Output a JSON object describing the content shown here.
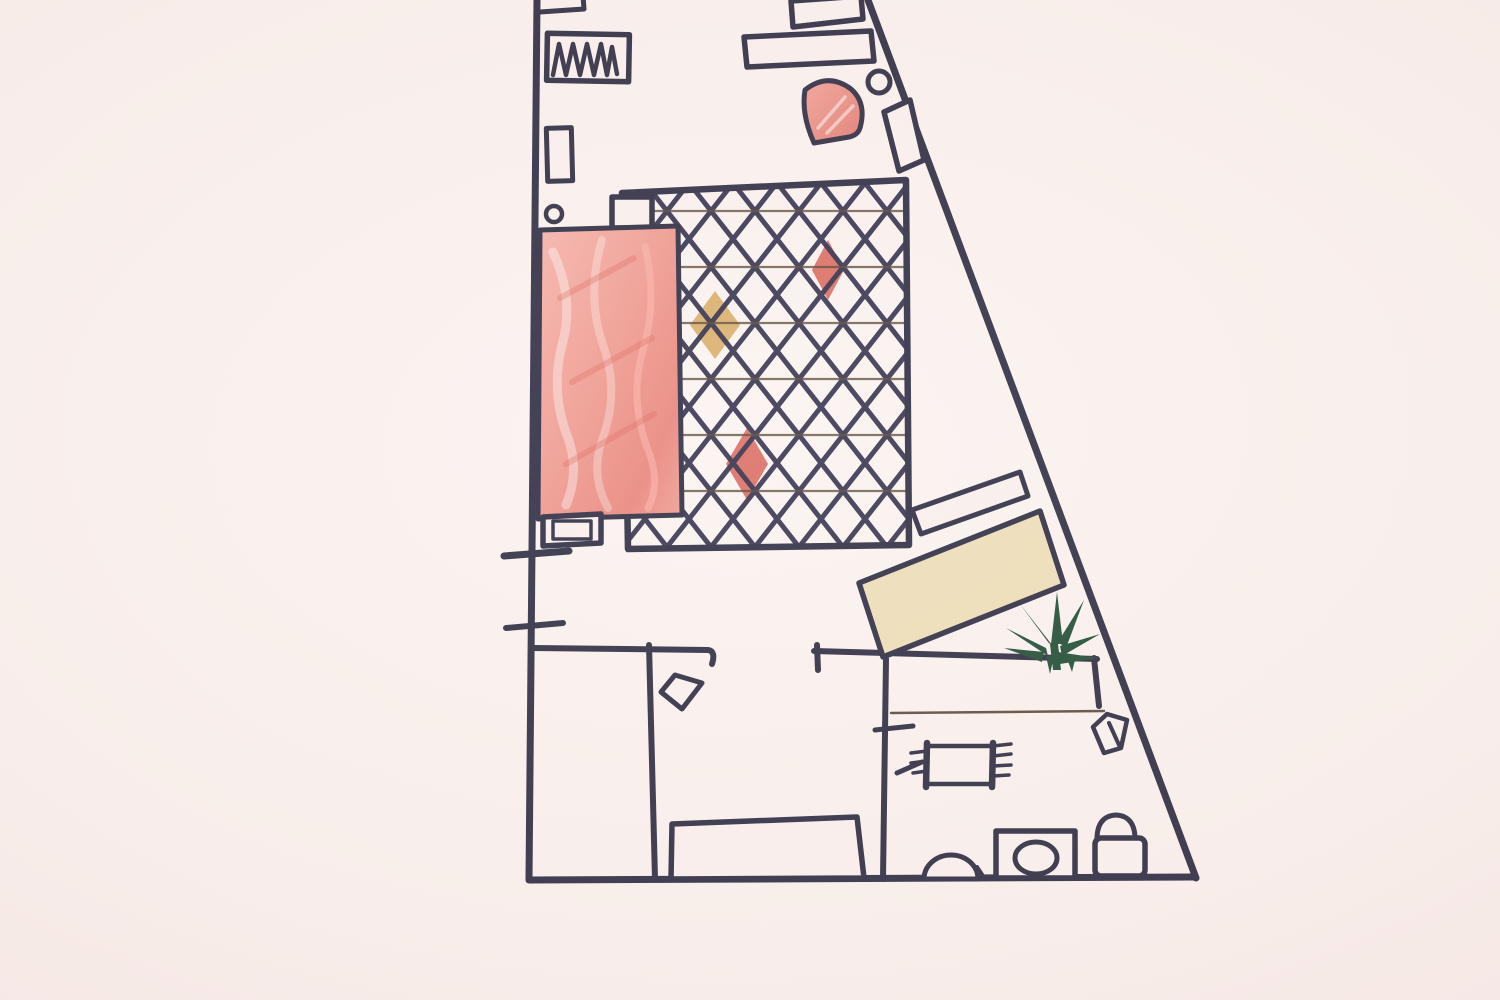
{
  "scene": {
    "kind": "hand-drawn-floor-plan-sketch",
    "medium": "ink-and-crayon-on-paper"
  },
  "palette": {
    "paper": "#f9efec",
    "ink": "#2c2a40",
    "ink_thin": "#5a4a3c",
    "crayon_red_deep": "#db6d63",
    "crayon_tan": "#d9ae6b",
    "beige": "#ecdcb6",
    "plant_green": "#1d4a30"
  },
  "elements": [
    {
      "name": "left-wall",
      "kind": "line",
      "x1": 537,
      "y1": 0,
      "x2": 529,
      "y2": 879,
      "sw": 7
    },
    {
      "name": "bottom-wall",
      "kind": "line",
      "x1": 529,
      "y1": 880,
      "x2": 1193,
      "y2": 877,
      "sw": 7
    },
    {
      "name": "right-wall",
      "kind": "line",
      "x1": 868,
      "y1": 0,
      "x2": 1196,
      "y2": 878,
      "sw": 7
    },
    {
      "name": "hall-wall-left",
      "kind": "path",
      "d": "M533,648 L708,650 Q716,651 712,664",
      "sw": 6
    },
    {
      "name": "room-divider-wall",
      "kind": "line",
      "x1": 649,
      "y1": 645,
      "x2": 655,
      "y2": 879,
      "sw": 6
    },
    {
      "name": "hall-wall-right",
      "kind": "line",
      "x1": 814,
      "y1": 651,
      "x2": 1097,
      "y2": 659,
      "sw": 6
    },
    {
      "name": "hall-wall-right-jamb",
      "kind": "line",
      "x1": 817,
      "y1": 645,
      "x2": 818,
      "y2": 670,
      "sw": 6
    },
    {
      "name": "bathroom-wall",
      "kind": "line",
      "x1": 886,
      "y1": 659,
      "x2": 883,
      "y2": 879,
      "sw": 6
    },
    {
      "name": "bathroom-right-wall-stub",
      "kind": "line",
      "x1": 1094,
      "y1": 658,
      "x2": 1099,
      "y2": 706,
      "sw": 6
    },
    {
      "name": "bathroom-counter-line",
      "kind": "line",
      "x1": 891,
      "y1": 713,
      "x2": 1104,
      "y2": 711,
      "stroke": "ink_thin",
      "sw": 2.5
    },
    {
      "name": "bathroom-wall-tick",
      "kind": "line",
      "x1": 875,
      "y1": 730,
      "x2": 913,
      "y2": 726,
      "sw": 5
    },
    {
      "name": "top-wall-shelf",
      "kind": "path",
      "d": "M540,12 L584,9 L583,-4",
      "sw": 5
    },
    {
      "name": "radiator-box",
      "kind": "rect",
      "x": 547,
      "y": 34,
      "w": 82,
      "h": 47,
      "rot": 1,
      "fill": "paper",
      "sw": 5.5
    },
    {
      "name": "radiator-coil",
      "kind": "polyline",
      "points": "553,75 559,44 566,75 573,44 580,75 587,44 594,75 601,44 607,75 612,47 617,74",
      "sw": 4.5
    },
    {
      "name": "wall-cabinet-small",
      "kind": "rect",
      "x": 547,
      "y": 128,
      "w": 25,
      "h": 53,
      "rot": -1.5,
      "fill": "paper",
      "sw": 5
    },
    {
      "name": "door-hinge-circle-left",
      "kind": "circle",
      "cx": 554,
      "cy": 214,
      "r": 8,
      "sw": 4.5
    },
    {
      "name": "top-right-cabinet",
      "kind": "polygon",
      "points": "791,1 861,-4 863,19 793,27",
      "fill": "paper",
      "sw": 5.5
    },
    {
      "name": "sideboard",
      "kind": "polygon",
      "points": "744,37 871,31 874,61 747,67",
      "fill": "paper",
      "sw": 5.5
    },
    {
      "name": "corner-armchair-red",
      "kind": "path",
      "d": "M805,90 Q828,72 851,89 Q867,103 860,128 Q858,135 849,137 L814,143 Q801,114 805,90 Z",
      "fill": "url(#fanFill)",
      "sw": 5
    },
    {
      "name": "armchair-highlight",
      "kind": "path",
      "d": "M818,128 L845,97 M827,133 L853,106",
      "stroke": "rgba(255,255,255,0.5)",
      "sw": 3.5
    },
    {
      "name": "door-hinge-circle-right",
      "kind": "circle",
      "cx": 879,
      "cy": 82,
      "r": 11,
      "sw": 5
    },
    {
      "name": "entry-door-panel",
      "kind": "polygon",
      "points": "884,112 910,100 924,160 899,171",
      "fill": "paper",
      "sw": 5.5
    },
    {
      "name": "rug-diamond-tan",
      "kind": "polygon",
      "points": "715,291 740,325 715,359 690,325",
      "fill": "crayon_tan",
      "stroke": null
    },
    {
      "name": "rug-diamond-red-top",
      "kind": "polygon",
      "points": "828,240 844,270 828,300 812,270",
      "fill": "crayon_red_deep",
      "stroke": null
    },
    {
      "name": "rug-diamond-red-bottom",
      "kind": "polygon",
      "points": "747,428 768,464 747,500 726,464",
      "fill": "crayon_red_deep",
      "stroke": null
    },
    {
      "name": "rug-lattice",
      "kind": "polygon",
      "points": "622,193 906,180 909,545 628,549",
      "fill": "url(#rugpat)",
      "stroke": null
    },
    {
      "name": "rug-border",
      "kind": "polygon",
      "points": "622,193 906,180 909,545 628,549",
      "sw": 6.5
    },
    {
      "name": "rug-corner-box",
      "kind": "rect",
      "x": 612,
      "y": 197,
      "w": 40,
      "h": 31,
      "fill": "paper",
      "sw": 5.5
    },
    {
      "name": "bed",
      "kind": "polygon",
      "points": "540,230 678,226 682,515 538,519",
      "fill": "url(#bedFill)",
      "sw": 5
    },
    {
      "name": "bed-scribble-light-1",
      "kind": "path",
      "d": "M553,252 Q575,300 562,345 Q550,392 568,438 Q580,472 566,505",
      "stroke": "rgba(255,255,255,0.38)",
      "sw": 9
    },
    {
      "name": "bed-scribble-light-2",
      "kind": "path",
      "d": "M602,240 Q586,295 603,345 Q620,392 602,440 Q590,475 608,508",
      "stroke": "rgba(255,255,255,0.30)",
      "sw": 8
    },
    {
      "name": "bed-scribble-pink",
      "kind": "path",
      "d": "M645,246 Q658,300 643,350 Q628,402 650,455 Q660,485 648,508",
      "stroke": "rgba(252,180,170,0.55)",
      "sw": 7
    },
    {
      "name": "bed-scribble-red",
      "kind": "path",
      "d": "M560,298 L634,258 M572,382 L652,338 M566,464 L654,414",
      "stroke": "rgba(215,85,75,0.30)",
      "sw": 6
    },
    {
      "name": "nightstand",
      "kind": "polygon",
      "points": "543,517 601,514 601,543 543,546",
      "fill": "paper",
      "sw": 5.5
    },
    {
      "name": "nightstand-inner",
      "kind": "rect",
      "x": 553,
      "y": 521,
      "w": 38,
      "h": 18,
      "sw": 3.5
    },
    {
      "name": "window-tick-upper",
      "kind": "line",
      "x1": 504,
      "y1": 556,
      "x2": 569,
      "y2": 551,
      "sw": 7
    },
    {
      "name": "window-tick-lower",
      "kind": "line",
      "x1": 506,
      "y1": 628,
      "x2": 563,
      "y2": 623,
      "sw": 6
    },
    {
      "name": "console-shelf",
      "kind": "polygon",
      "points": "912,510 1020,472 1028,496 921,534",
      "fill": "paper",
      "sw": 5
    },
    {
      "name": "sofa",
      "kind": "polygon",
      "points": "859,583 1040,511 1064,585 883,657",
      "fill": "beige",
      "sw": 5.5
    },
    {
      "name": "plant-leaf-up",
      "kind": "polygon",
      "points": "1051,644 1057,592 1063,644",
      "fill": "plant_green",
      "stroke": null
    },
    {
      "name": "plant-leaf-upper-left",
      "kind": "polygon",
      "points": "1048,642 1020,604 1056,650",
      "fill": "plant_green",
      "stroke": null
    },
    {
      "name": "plant-leaf-left",
      "kind": "polygon",
      "points": "1046,648 1006,628 1048,656",
      "fill": "plant_green",
      "stroke": null
    },
    {
      "name": "plant-leaf-lower-left",
      "kind": "polygon",
      "points": "1044,652 1004,648 1042,662",
      "fill": "plant_green",
      "stroke": null
    },
    {
      "name": "plant-leaf-upper-right",
      "kind": "polygon",
      "points": "1058,642 1084,600 1066,648",
      "fill": "plant_green",
      "stroke": null
    },
    {
      "name": "plant-leaf-right",
      "kind": "polygon",
      "points": "1060,646 1100,634 1062,656",
      "fill": "plant_green",
      "stroke": null
    },
    {
      "name": "plant-leaf-lower-right",
      "kind": "polygon",
      "points": "1058,652 1098,658 1060,664",
      "fill": "plant_green",
      "stroke": null
    },
    {
      "name": "plant-trunk",
      "kind": "polygon",
      "points": "1050,644 1053,670 1061,670 1058,644",
      "fill": "plant_green",
      "stroke": null
    },
    {
      "name": "plant-root-left",
      "kind": "polygon",
      "points": "1046,656 1050,674 1054,656",
      "fill": "plant_green",
      "stroke": null
    },
    {
      "name": "plant-root-right",
      "kind": "polygon",
      "points": "1066,656 1072,672 1076,656",
      "fill": "plant_green",
      "stroke": null
    },
    {
      "name": "door-swing-square",
      "kind": "polygon",
      "points": "675,675 702,683 682,709 661,692",
      "sw": 5
    },
    {
      "name": "bench",
      "kind": "polygon",
      "points": "672,824 857,817 864,878 671,879",
      "fill": "paper",
      "sw": 5.5
    },
    {
      "name": "bath-mat",
      "kind": "rect",
      "x": 927,
      "y": 746,
      "w": 66,
      "h": 38,
      "sw": 4.5
    },
    {
      "name": "bath-mat-bar-left",
      "kind": "line",
      "x1": 927,
      "y1": 743,
      "x2": 926,
      "y2": 787,
      "sw": 6.5
    },
    {
      "name": "bath-mat-bar-right",
      "kind": "line",
      "x1": 993,
      "y1": 743,
      "x2": 992,
      "y2": 787,
      "sw": 6.5
    },
    {
      "name": "bath-mat-fringe-left",
      "kind": "path",
      "d": "M911,753 L927,751 M911,763 L927,761 M913,773 L927,771",
      "sw": 3.5
    },
    {
      "name": "bath-mat-fringe-right",
      "kind": "path",
      "d": "M993,746 L1011,744 M993,756 L1011,754 M993,766 L1011,765 M993,776 L1009,775",
      "sw": 3.5
    },
    {
      "name": "bath-mat-tail",
      "kind": "line",
      "x1": 897,
      "y1": 773,
      "x2": 922,
      "y2": 762,
      "sw": 5
    },
    {
      "name": "sink",
      "kind": "path",
      "d": "M924,879 A27,24 0 0 1 978,879 Z",
      "fill": "paper",
      "sw": 5
    },
    {
      "name": "sink-foot",
      "kind": "line",
      "x1": 977,
      "y1": 867,
      "x2": 985,
      "y2": 879,
      "sw": 4
    },
    {
      "name": "washing-machine",
      "kind": "rect",
      "x": 996,
      "y": 831,
      "w": 79,
      "h": 47,
      "fill": "paper",
      "sw": 5.5
    },
    {
      "name": "washing-machine-drum",
      "kind": "ellipse",
      "cx": 1036,
      "cy": 858,
      "rx": 21,
      "ry": 16,
      "sw": 5
    },
    {
      "name": "toilet-tank",
      "kind": "path",
      "d": "M1097,842 Q1096,816 1116,815 Q1136,816 1135,842",
      "fill": "paper",
      "sw": 5
    },
    {
      "name": "toilet-bowl",
      "kind": "rect",
      "x": 1095,
      "y": 838,
      "w": 50,
      "h": 38,
      "r": 6,
      "fill": "paper",
      "sw": 5.5
    },
    {
      "name": "bath-door-swing",
      "kind": "path",
      "d": "M1093,727 L1107,714 L1127,720 L1121,748 L1104,753 Z",
      "sw": 4.5
    },
    {
      "name": "bath-door-swing-inner",
      "kind": "line",
      "x1": 1109,
      "y1": 723,
      "x2": 1119,
      "y2": 745,
      "sw": 4
    }
  ]
}
